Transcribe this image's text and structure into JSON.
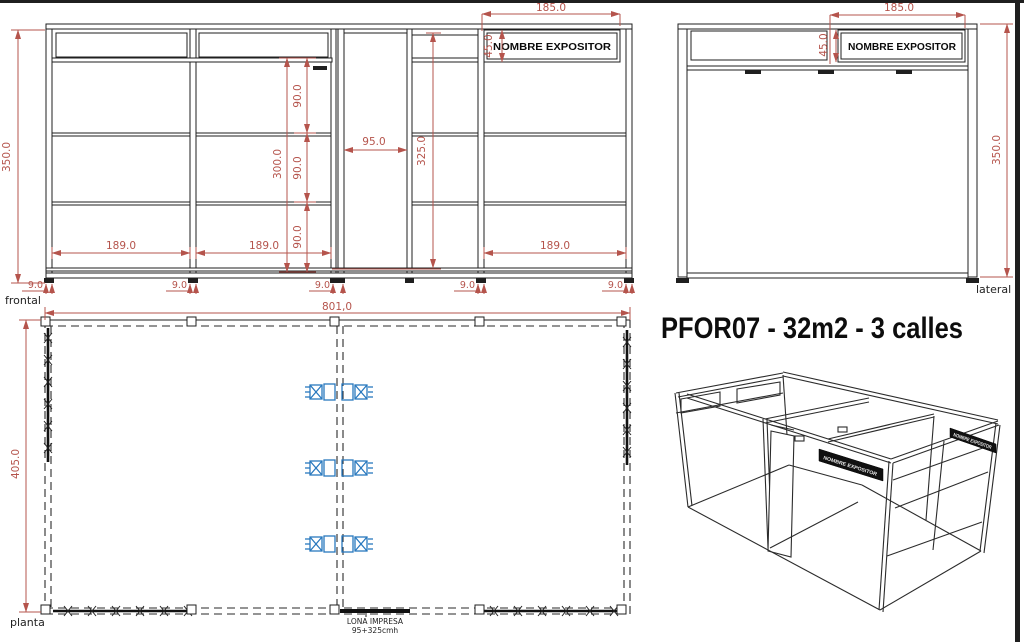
{
  "title": "PFOR07 - 32m2 - 3 calles",
  "colors": {
    "dimension": "#b5544c",
    "line": "#1f1f1f",
    "outlet_blue": "#2878be"
  },
  "frontal": {
    "label": "frontal",
    "sign": "NOMBRE  EXPOSITOR",
    "dim_total_height": "350.0",
    "dim_sign_width": "185.0",
    "dim_sign_height": "45.0",
    "dim_door_width": "95.0",
    "dim_door_height": "325.0",
    "dim_wall_height": "300.0",
    "dims_panel": [
      "90.0",
      "90.0",
      "90.0"
    ],
    "dims_bay": [
      "189.0",
      "189.0",
      "189.0"
    ],
    "dims_post": [
      "9.0",
      "9.0",
      "9.0",
      "9.0",
      "9.0"
    ]
  },
  "lateral": {
    "label": "lateral",
    "sign": "NOMBRE  EXPOSITOR",
    "dim_sign_width": "185.0",
    "dim_sign_height": "45.0",
    "dim_total_height": "350.0"
  },
  "planta": {
    "label": "planta",
    "dim_width": "801,0",
    "dim_depth": "405.0",
    "banner_note_line1": "LONA  IMPRESA",
    "banner_note_line2": "95+325cmh"
  },
  "iso": {
    "sign_mid": "NOMBRE EXPOSITOR",
    "sign_right": "NOMBRE EXPOSITOR"
  }
}
